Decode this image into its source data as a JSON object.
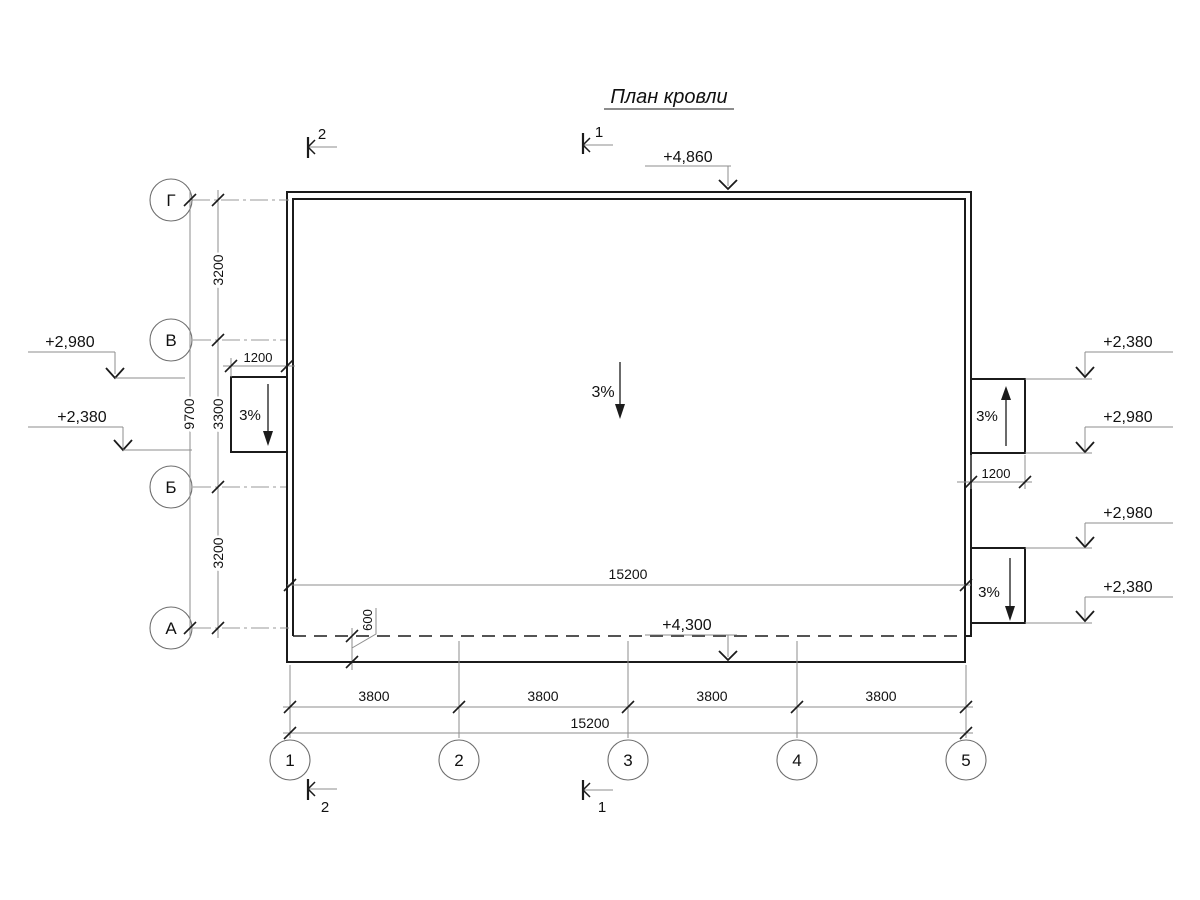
{
  "title": {
    "text": "План кровли"
  },
  "elevations": {
    "top": "+4,860",
    "bottom": "+4,300",
    "left_upper": "+2,980",
    "left_lower": "+2,380",
    "right_1": "+2,380",
    "right_2": "+2,980",
    "right_3": "+2,980",
    "right_4": "+2,380"
  },
  "slopes": {
    "main": "3%",
    "left_canopy": "3%",
    "right_upper_canopy": "3%",
    "right_lower_canopy": "3%"
  },
  "axes_left": [
    "Г",
    "В",
    "Б",
    "А"
  ],
  "axes_bottom": [
    "1",
    "2",
    "3",
    "4",
    "5"
  ],
  "dims": {
    "left_segments": [
      "3200",
      "3300",
      "3200"
    ],
    "left_total": "9700",
    "left_canopy": "1200",
    "right_canopy": "1200",
    "roof_inner_width": "15200",
    "eave_offset": "600",
    "bottom_segments": [
      "3800",
      "3800",
      "3800",
      "3800"
    ],
    "bottom_total": "15200"
  },
  "sections": {
    "top_left": "2",
    "top_center": "1",
    "bottom_left": "2",
    "bottom_center": "1"
  },
  "colors": {
    "outline": "#1b1b1b",
    "dimension": "#8e8e8e"
  }
}
